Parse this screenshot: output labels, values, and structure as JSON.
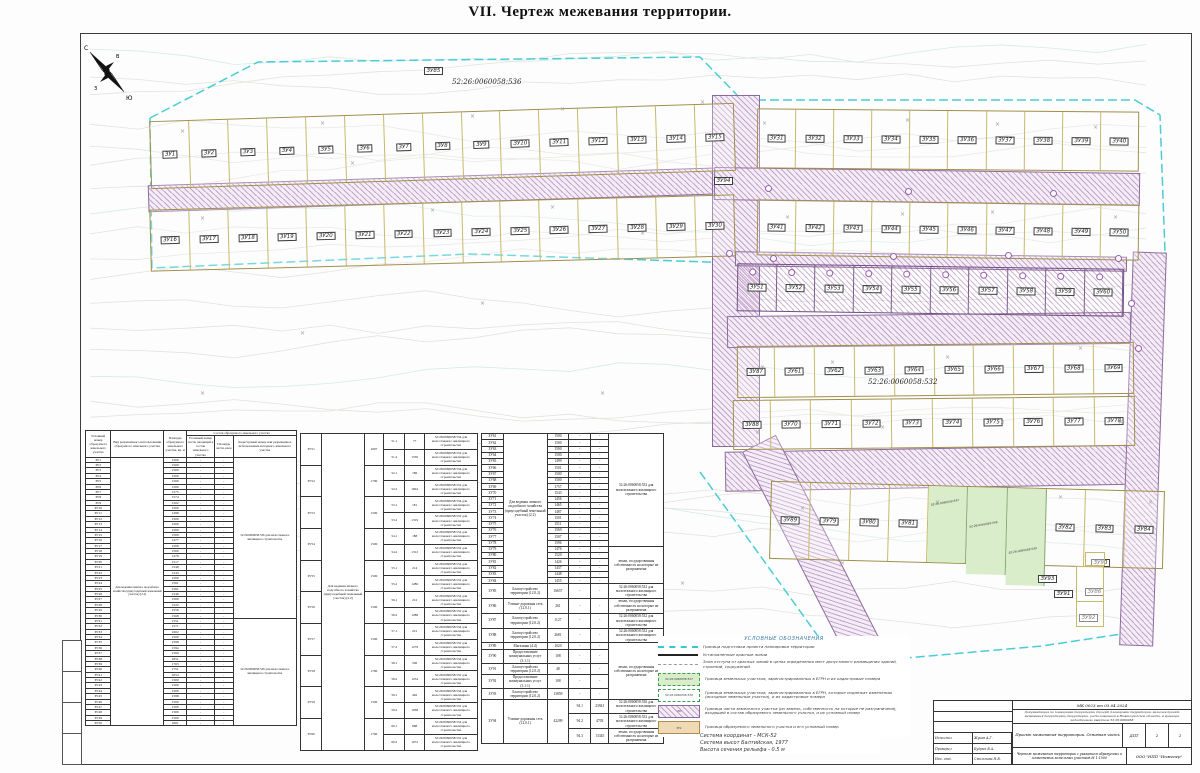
{
  "title": "VII.   Чертеж межевания территории.",
  "compass": {
    "n": "С",
    "s": "Ю",
    "w": "З",
    "e": "В"
  },
  "map": {
    "cad_top": "52:26:0060058:536",
    "cad_mid": "52:26:0060058:532",
    "green_cads": [
      "52:26:0060058:547",
      "52:26:0060058:548",
      "52:26:0060058:549"
    ],
    "blocks": {
      "a": [
        "ЗУ1",
        "ЗУ2",
        "ЗУ3",
        "ЗУ4",
        "ЗУ5",
        "ЗУ6",
        "ЗУ7",
        "ЗУ8",
        "ЗУ9",
        "ЗУ10",
        "ЗУ11",
        "ЗУ12",
        "ЗУ13",
        "ЗУ14",
        "ЗУ15"
      ],
      "b": [
        "ЗУ16",
        "ЗУ17",
        "ЗУ18",
        "ЗУ19",
        "ЗУ20",
        "ЗУ21",
        "ЗУ22",
        "ЗУ23",
        "ЗУ24",
        "ЗУ25",
        "ЗУ26",
        "ЗУ27",
        "ЗУ28",
        "ЗУ29",
        "ЗУ30"
      ],
      "c": [
        "ЗУ31",
        "ЗУ32",
        "ЗУ33",
        "ЗУ34",
        "ЗУ35",
        "ЗУ36",
        "ЗУ37",
        "ЗУ38",
        "ЗУ39",
        "ЗУ40"
      ],
      "d": [
        "ЗУ41",
        "ЗУ42",
        "ЗУ43",
        "ЗУ44",
        "ЗУ45",
        "ЗУ46",
        "ЗУ47",
        "ЗУ48",
        "ЗУ49",
        "ЗУ50"
      ],
      "e": [
        "ЗУ51",
        "ЗУ52",
        "ЗУ53",
        "ЗУ54",
        "ЗУ55",
        "ЗУ56",
        "ЗУ57",
        "ЗУ58",
        "ЗУ59",
        "ЗУ60"
      ],
      "f1": [
        "ЗУ87",
        "ЗУ61",
        "ЗУ62",
        "ЗУ63",
        "ЗУ64",
        "ЗУ65",
        "ЗУ66",
        "ЗУ67",
        "ЗУ68",
        "ЗУ69"
      ],
      "f2": [
        "ЗУ88",
        "ЗУ70",
        "ЗУ71",
        "ЗУ72",
        "ЗУ73",
        "ЗУ74",
        "ЗУ75",
        "ЗУ76",
        "ЗУ77",
        "ЗУ78"
      ],
      "g_left": [
        "ЗУ89",
        "ЗУ79",
        "ЗУ80",
        "ЗУ81"
      ],
      "g_right": [
        "ЗУ82",
        "ЗУ83",
        "ЗУ84"
      ],
      "zu85": "ЗУ85",
      "zu94": "ЗУ94",
      "zu86": "ЗУ86",
      "zu90": "ЗУ90",
      "zu91": "ЗУ91",
      "zu92": "ЗУ92",
      "zu93": "ЗУ93"
    }
  },
  "tables": {
    "dash": "-",
    "headers": {
      "h1": "Условный номер образуемого земельного участка",
      "h2": "Вид разрешенного использования образуемого земельного участка",
      "h3": "Площадь образуемого земельного участка, кв. м",
      "h4": "Состав образуемого земельного участка",
      "h5": "Условный номер части, входящей в состав земельного участка",
      "h6": "Площадь части, кв.м",
      "h7": "Кадастровый номер или разрешенное использование исходного земельного участка"
    },
    "t1": {
      "vid": "Для ведения личного подсобного хозяйства (приусадебный земельный участок) (2.2)",
      "cad_a": "52:26:0060058:536 для малоэтажного жилищного строительства",
      "cad_a_rows": 30,
      "cad_b": "52:26:0060058:530 для малоэтажного жилищного строительства",
      "ids": [
        "ЗУ1",
        "ЗУ2",
        "ЗУ3",
        "ЗУ4",
        "ЗУ5",
        "ЗУ6",
        "ЗУ7",
        "ЗУ8",
        "ЗУ9",
        "ЗУ10",
        "ЗУ11",
        "ЗУ12",
        "ЗУ13",
        "ЗУ14",
        "ЗУ15",
        "ЗУ16",
        "ЗУ17",
        "ЗУ18",
        "ЗУ19",
        "ЗУ20",
        "ЗУ21",
        "ЗУ22",
        "ЗУ23",
        "ЗУ24",
        "ЗУ25",
        "ЗУ26",
        "ЗУ27",
        "ЗУ28",
        "ЗУ29",
        "ЗУ30",
        "ЗУ31",
        "ЗУ32",
        "ЗУ33",
        "ЗУ34",
        "ЗУ35",
        "ЗУ36",
        "ЗУ37",
        "ЗУ38",
        "ЗУ39",
        "ЗУ40",
        "ЗУ41",
        "ЗУ42",
        "ЗУ43",
        "ЗУ44",
        "ЗУ45",
        "ЗУ46",
        "ЗУ47",
        "ЗУ48",
        "ЗУ49",
        "ЗУ50"
      ],
      "areas": [
        "1500",
        "1500",
        "1500",
        "1500",
        "1500",
        "1500",
        "1575",
        "1574",
        "1502",
        "1500",
        "1498",
        "1500",
        "1500",
        "1500",
        "1500",
        "1477",
        "1508",
        "1500",
        "1476",
        "1517",
        "1548",
        "1543",
        "1500",
        "1501",
        "1561",
        "1546",
        "1500",
        "1522",
        "1556",
        "1568",
        "1551",
        "1571",
        "1602",
        "1500",
        "1598",
        "1594",
        "1500",
        "1651",
        "1763",
        "1751",
        "1654",
        "1500",
        "1500",
        "1500",
        "1598",
        "1500",
        "1500",
        "1500",
        "1500",
        "1601"
      ]
    },
    "t2": {
      "vid": "Для ведения личного подсобного хозяйства (приусадебный земельный участок) (2.2)",
      "cad_a": "52:26:0060058:534 для малоэтажного жилищного строительства",
      "cad_b": "52:26:0060058:532 для малоэтажного жилищного строительства",
      "plots": [
        {
          "id": "ЗУ51",
          "area": "1607",
          "parts": [
            [
              "51.1",
              "77"
            ],
            [
              "51.2",
              "1530"
            ]
          ]
        },
        {
          "id": "ЗУ52",
          "area": "1790",
          "parts": [
            [
              "52.1",
              "186"
            ],
            [
              "52.2",
              "1604"
            ]
          ]
        },
        {
          "id": "ЗУ53",
          "area": "1500",
          "parts": [
            [
              "53.1",
              "181"
            ],
            [
              "53.2",
              "1319"
            ]
          ]
        },
        {
          "id": "ЗУ54",
          "area": "1500",
          "parts": [
            [
              "54.1",
              "188"
            ],
            [
              "54.2",
              "1312"
            ]
          ]
        },
        {
          "id": "ЗУ55",
          "area": "1500",
          "parts": [
            [
              "55.1",
              "214"
            ],
            [
              "55.2",
              "1286"
            ]
          ]
        },
        {
          "id": "ЗУ56",
          "area": "1500",
          "parts": [
            [
              "56.1",
              "212"
            ],
            [
              "56.2",
              "1288"
            ]
          ]
        },
        {
          "id": "ЗУ57",
          "area": "1500",
          "parts": [
            [
              "57.1",
              "221"
            ],
            [
              "57.2",
              "1279"
            ]
          ]
        },
        {
          "id": "ЗУ58",
          "area": "1760",
          "parts": [
            [
              "58.1",
              "506"
            ],
            [
              "58.2",
              "1254"
            ]
          ]
        },
        {
          "id": "ЗУ59",
          "area": "1500",
          "parts": [
            [
              "59.1",
              "462"
            ],
            [
              "59.2",
              "1038"
            ]
          ]
        },
        {
          "id": "ЗУ60",
          "area": "1760",
          "parts": [
            [
              "60.1",
              "688"
            ],
            [
              "60.2",
              "1072"
            ]
          ]
        }
      ]
    },
    "t3": {
      "vid": "Для ведения личного подсобного хозяйства (приусадебный земельный участок) (2.2)",
      "cad_532": "52:26:0060058:532 для малоэтажного жилищного строительства",
      "cad_536": "52:26:0060058:536 для малоэтажного жилищного строительства",
      "cad_state": "земли, государственная собственность на которые не разграничена",
      "cad_532_rows": 18,
      "simple": [
        [
          "ЗУ61",
          "1500"
        ],
        [
          "ЗУ62",
          "1500"
        ],
        [
          "ЗУ63",
          "1500"
        ],
        [
          "ЗУ64",
          "1500"
        ],
        [
          "ЗУ65",
          "1499"
        ],
        [
          "ЗУ66",
          "1501"
        ],
        [
          "ЗУ67",
          "1500"
        ],
        [
          "ЗУ68",
          "1500"
        ],
        [
          "ЗУ69",
          "1757"
        ],
        [
          "ЗУ70",
          "1543"
        ],
        [
          "ЗУ71",
          "1456"
        ],
        [
          "ЗУ72",
          "1465"
        ],
        [
          "ЗУ73",
          "1487"
        ],
        [
          "ЗУ74",
          "1501"
        ],
        [
          "ЗУ75",
          "1511"
        ],
        [
          "ЗУ76",
          "1569"
        ],
        [
          "ЗУ77",
          "1507"
        ],
        [
          "ЗУ78",
          "1596"
        ],
        [
          "ЗУ79",
          "1476"
        ],
        [
          "ЗУ80",
          "1520"
        ],
        [
          "ЗУ81",
          "1426"
        ],
        [
          "ЗУ82",
          "1437"
        ],
        [
          "ЗУ83",
          "1448"
        ],
        [
          "ЗУ84",
          "1455"
        ]
      ],
      "special": [
        {
          "id": "ЗУ85",
          "vid": "Благоустройство территории (12.0.2)",
          "area": "16657",
          "cad": "c532"
        },
        {
          "id": "ЗУ86",
          "vid": "Улично-дорожная сеть (12.0.1)",
          "area": "261",
          "cad": "state"
        },
        {
          "id": "ЗУ87",
          "vid": "Благоустройство территории (12.0.2)",
          "area": "1127",
          "cad": "c532"
        },
        {
          "id": "ЗУ88",
          "vid": "Благоустройство территории (12.0.2)",
          "area": "2681",
          "cad": "c532"
        },
        {
          "id": "ЗУ89",
          "vid": "Магазины (4.4)",
          "area": "1020",
          "cad": "state5"
        },
        {
          "id": "ЗУ90",
          "vid": "Предоставление коммунальных услуг (3.1.1)",
          "area": "108",
          "cad": null
        },
        {
          "id": "ЗУ91",
          "vid": "Благоустройство территории (12.0.2)",
          "area": "48",
          "cad": null
        },
        {
          "id": "ЗУ92",
          "vid": "Предоставление коммунальных услуг (3.1.1)",
          "area": "108",
          "cad": null
        },
        {
          "id": "ЗУ93",
          "vid": "Благоустройство территории (12.0.2)",
          "area": "13859",
          "cad": null
        }
      ],
      "zu94": {
        "id": "ЗУ94",
        "vid": "Улично-дорожная сеть (12.0.1)",
        "area": "42209",
        "parts": [
          [
            "94.1",
            "23941",
            "c536"
          ],
          [
            "94.2",
            "4703",
            "c532"
          ],
          [
            "94.3",
            "13345",
            "state"
          ]
        ]
      }
    }
  },
  "legend": {
    "title": "УСЛОВНЫЕ ОБОЗНАЧЕНИЯ",
    "items": [
      {
        "type": "cyan",
        "label": "Граница подготовки проекта планировки территории"
      },
      {
        "type": "black",
        "label": "Установленные красные линии"
      },
      {
        "type": "offset",
        "label": "Зона отступа от красных линий в целях определения мест допустимого размещения зданий, строений, сооружений"
      },
      {
        "type": "green",
        "swatch_text": "52:26:0060058:547",
        "label": "Граница земельных участков, зарегистрированных в ЕГРН и их кадастровые номера"
      },
      {
        "type": "white",
        "swatch_text": "52:26:0060058:536",
        "label": "Граница земельных участков, зарегистрированных в ЕГРН, которые подлежат изменению (исходные земельные участки), и их кадастровые номера"
      },
      {
        "type": "hatch",
        "swatch_text": ":59:",
        "label": "Граница части земельного участка (из земель, собственность на которые не разграничена), входящей в состав образуемого земельного участка, и их условный номер"
      },
      {
        "type": "tan",
        "swatch_text": "ЗУ1",
        "label": "Граница образуемого земельного участка и его условный номер"
      }
    ]
  },
  "notes": [
    "Система координат - МСК-52",
    "Система высот Балтийская, 1977",
    "Высота сечения рельефа - 0.5 м"
  ],
  "stamp": {
    "doc_no": "МК 0023 от 03.04.2024",
    "description": "Документация по планировке территории (проект планировки территории, включая проект межевания территории) территории, расположенной в Нижегородской области, в границах кадастрового квартала 52:26:0060058",
    "project": "Проект межевания территории. Основная часть",
    "stage": "ДПТ",
    "sheet": "2",
    "sheets": "2",
    "drawing": "Чертеж межевания территории с указанием образуемых и изменяемых земельных участков М 1:1500",
    "company": "ООО \"НПП \"Инженер\"",
    "signers": [
      [
        "Исполнил",
        "Жуков А.Г."
      ],
      [
        "Проверил",
        "Будрин В.А."
      ],
      [
        "Нач. отд.",
        "Смольнова Н.В."
      ]
    ]
  }
}
